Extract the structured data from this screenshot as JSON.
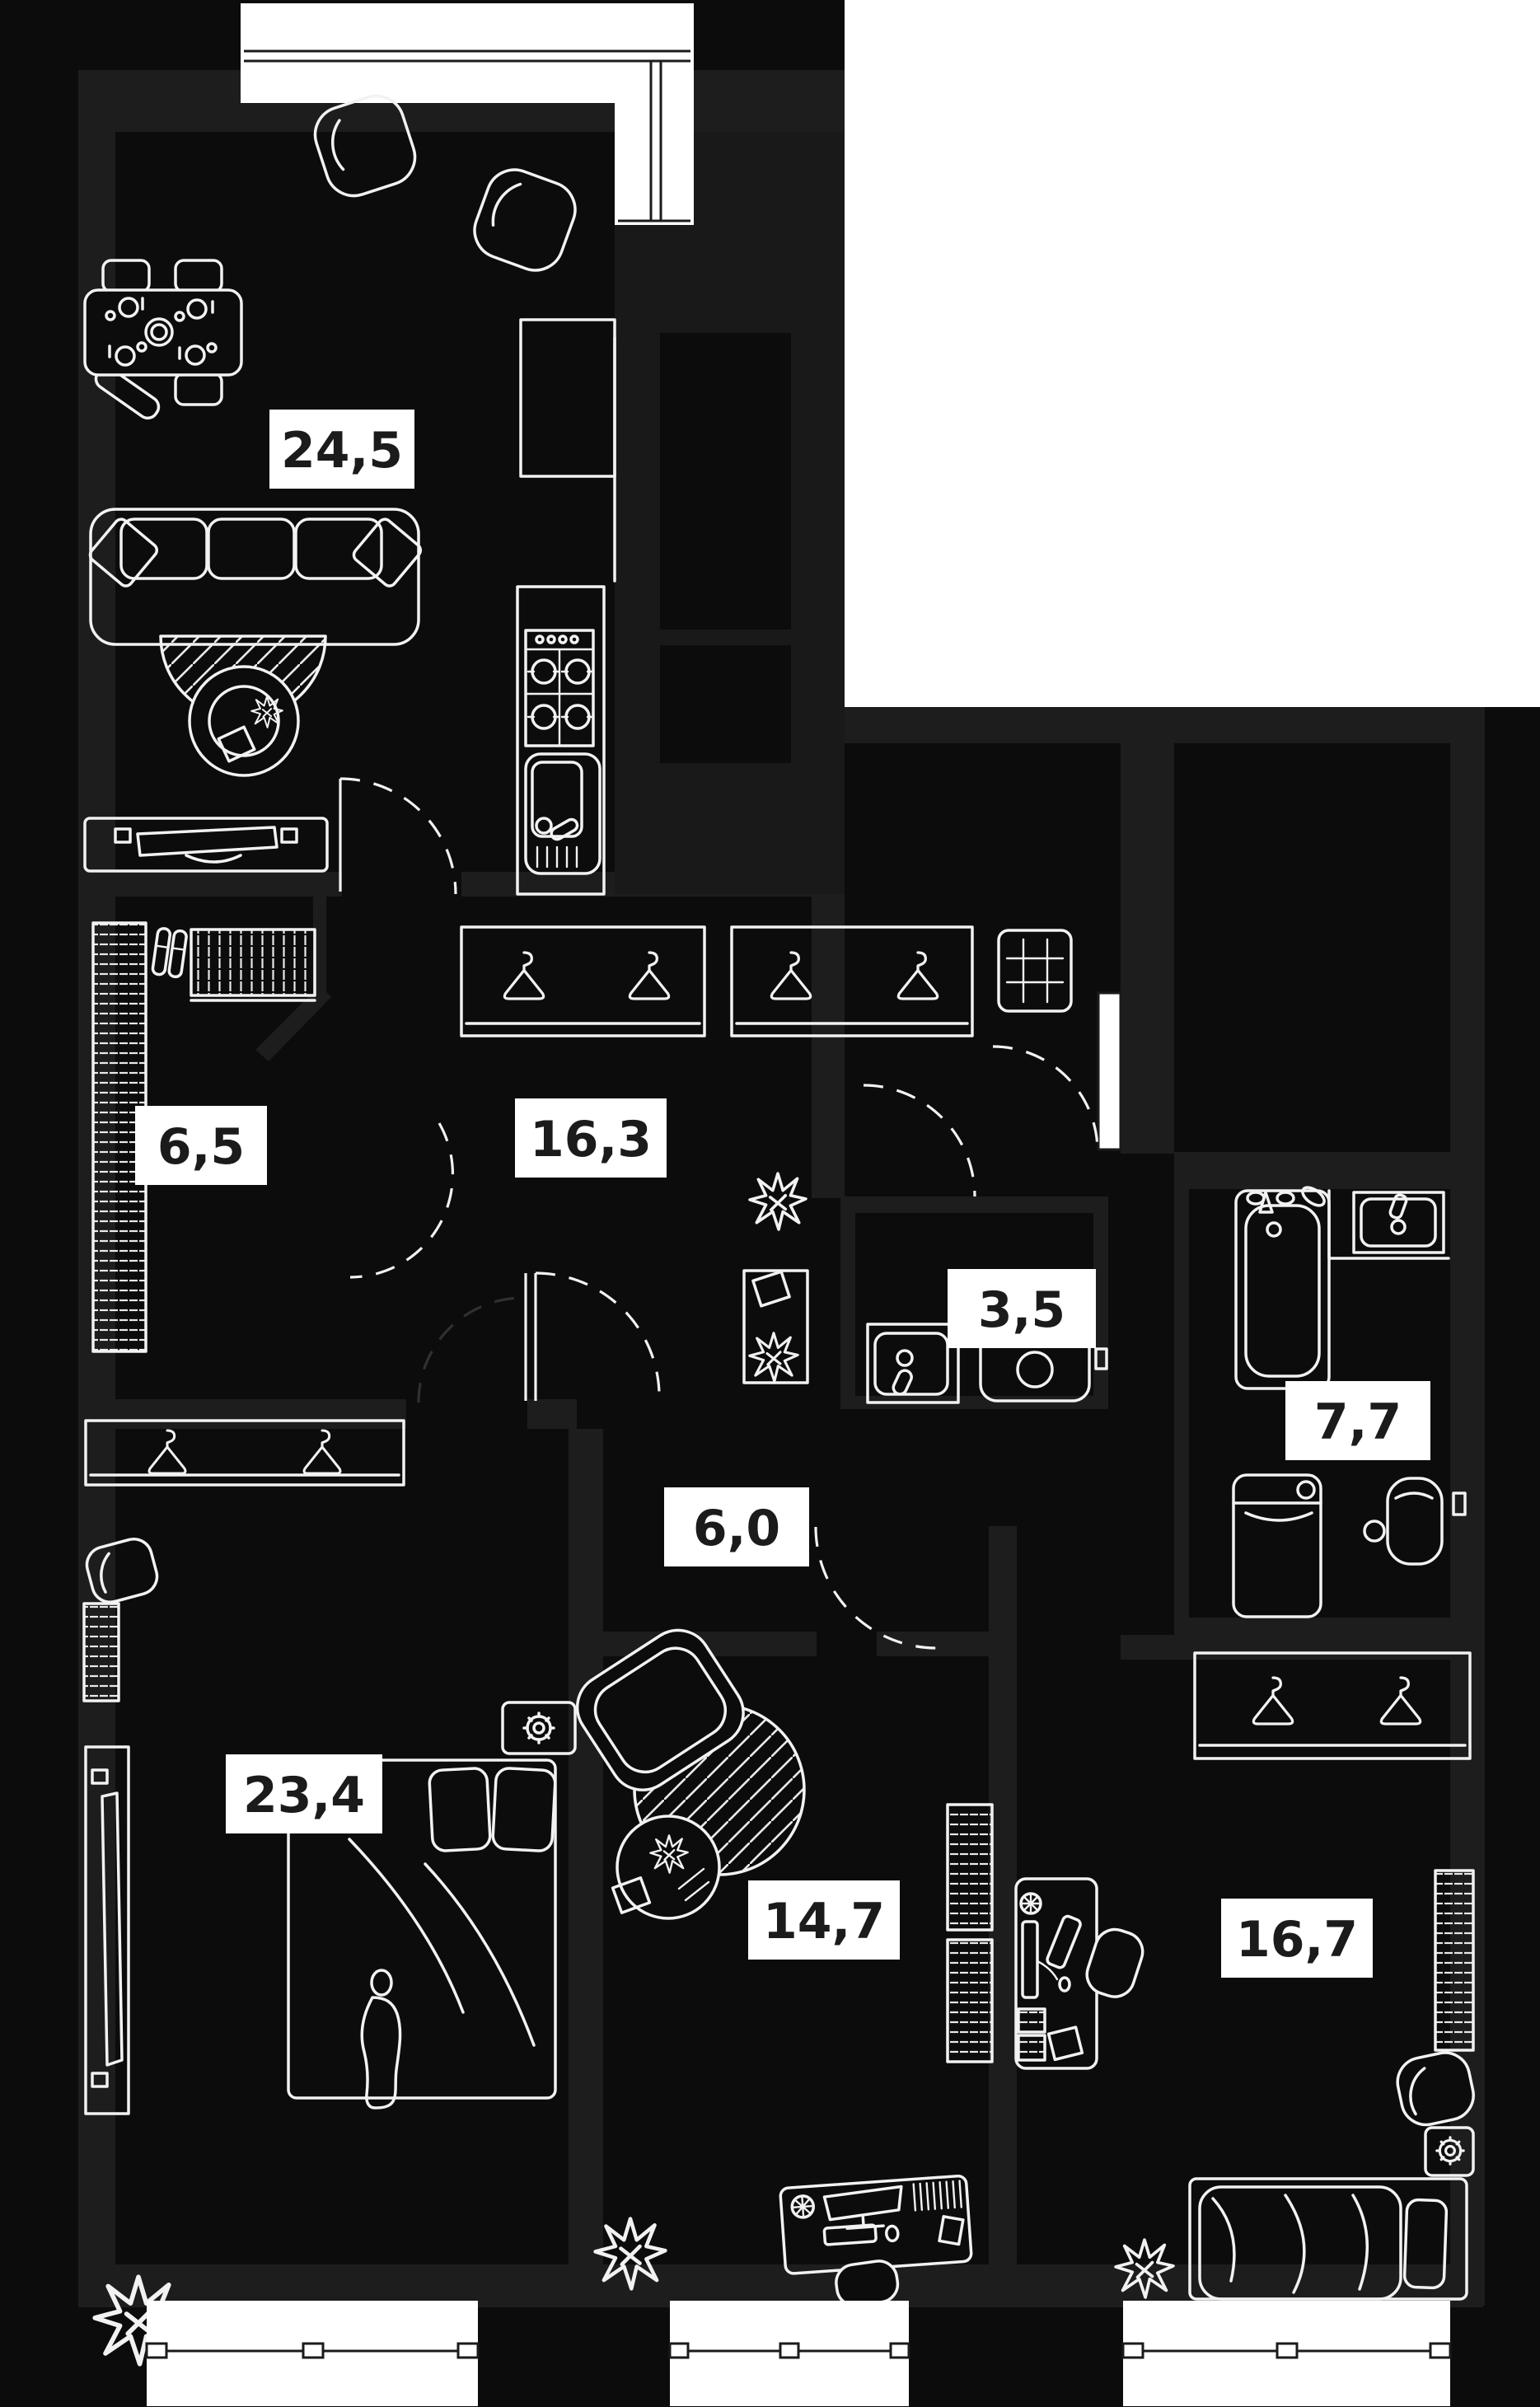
{
  "plan": {
    "type": "apartment-floor-plan",
    "area_unit": "m2",
    "rooms": [
      {
        "name": "living-room-kitchen",
        "area_label": "24,5"
      },
      {
        "name": "walk-in-closet",
        "area_label": "6,5"
      },
      {
        "name": "hallway",
        "area_label": "16,3"
      },
      {
        "name": "wc",
        "area_label": "3,5"
      },
      {
        "name": "bathroom",
        "area_label": "7,7"
      },
      {
        "name": "corridor",
        "area_label": "6,0"
      },
      {
        "name": "bedroom",
        "area_label": "23,4"
      },
      {
        "name": "room-middle",
        "area_label": "14,7"
      },
      {
        "name": "room-right",
        "area_label": "16,7"
      }
    ],
    "theme": {
      "background": "#0c0c0c",
      "wall": "#1d1d1d",
      "line": "#f2f2f2",
      "outside": "#ffffff",
      "label_background": "#ffffff",
      "label_text": "#1b1b1b"
    }
  }
}
